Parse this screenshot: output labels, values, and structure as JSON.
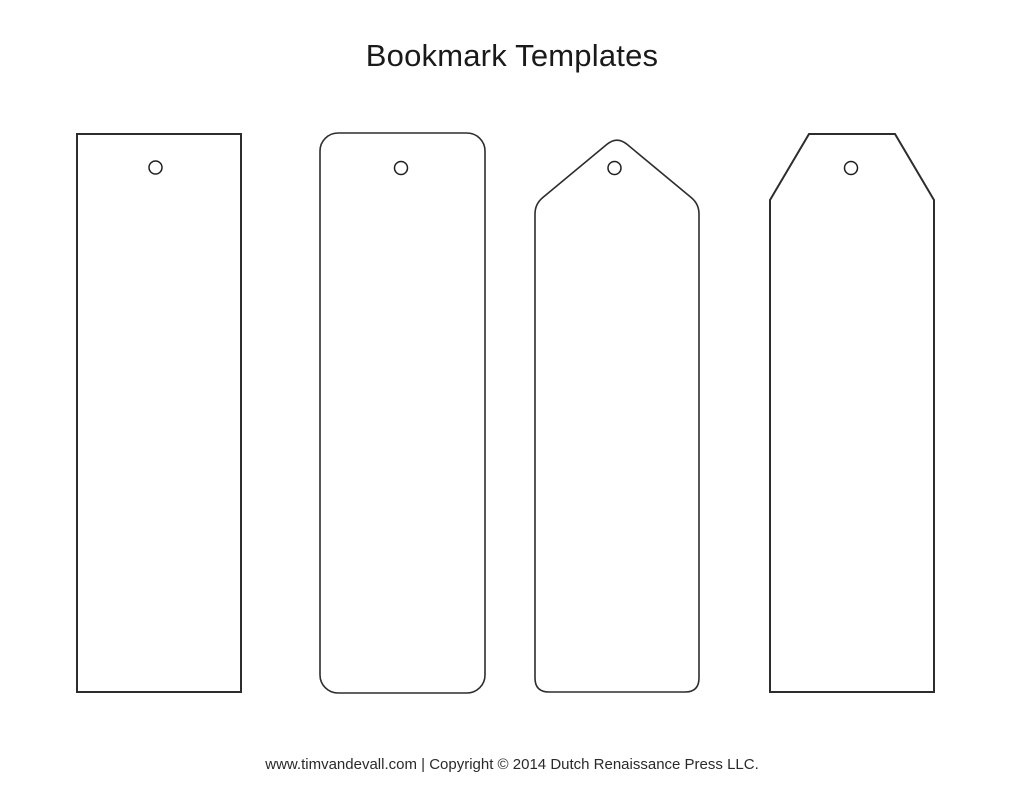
{
  "page": {
    "title": "Bookmark Templates",
    "footer": "www.timvandevall.com | Copyright © 2014 Dutch Renaissance Press LLC."
  },
  "colors": {
    "background": "#ffffff",
    "outline": "#2d2d2d",
    "hole_outline": "#1f1f1f",
    "title_text": "#1a1a1a",
    "footer_text": "#2a2a2a"
  },
  "bookmarks": [
    {
      "label": "rectangle-template",
      "shape": "rectangle",
      "top_style": "flat",
      "corner_style": "square",
      "punch_hole": true
    },
    {
      "label": "rounded-rectangle-template",
      "shape": "rounded-rectangle",
      "top_style": "flat",
      "corner_style": "rounded",
      "punch_hole": true
    },
    {
      "label": "pointed-tag-template",
      "shape": "pointed-tag",
      "top_style": "pointed",
      "corner_style": "rounded",
      "punch_hole": true
    },
    {
      "label": "chamfered-tag-template",
      "shape": "chamfered-tag",
      "top_style": "chamfered",
      "corner_style": "square",
      "punch_hole": true
    }
  ]
}
